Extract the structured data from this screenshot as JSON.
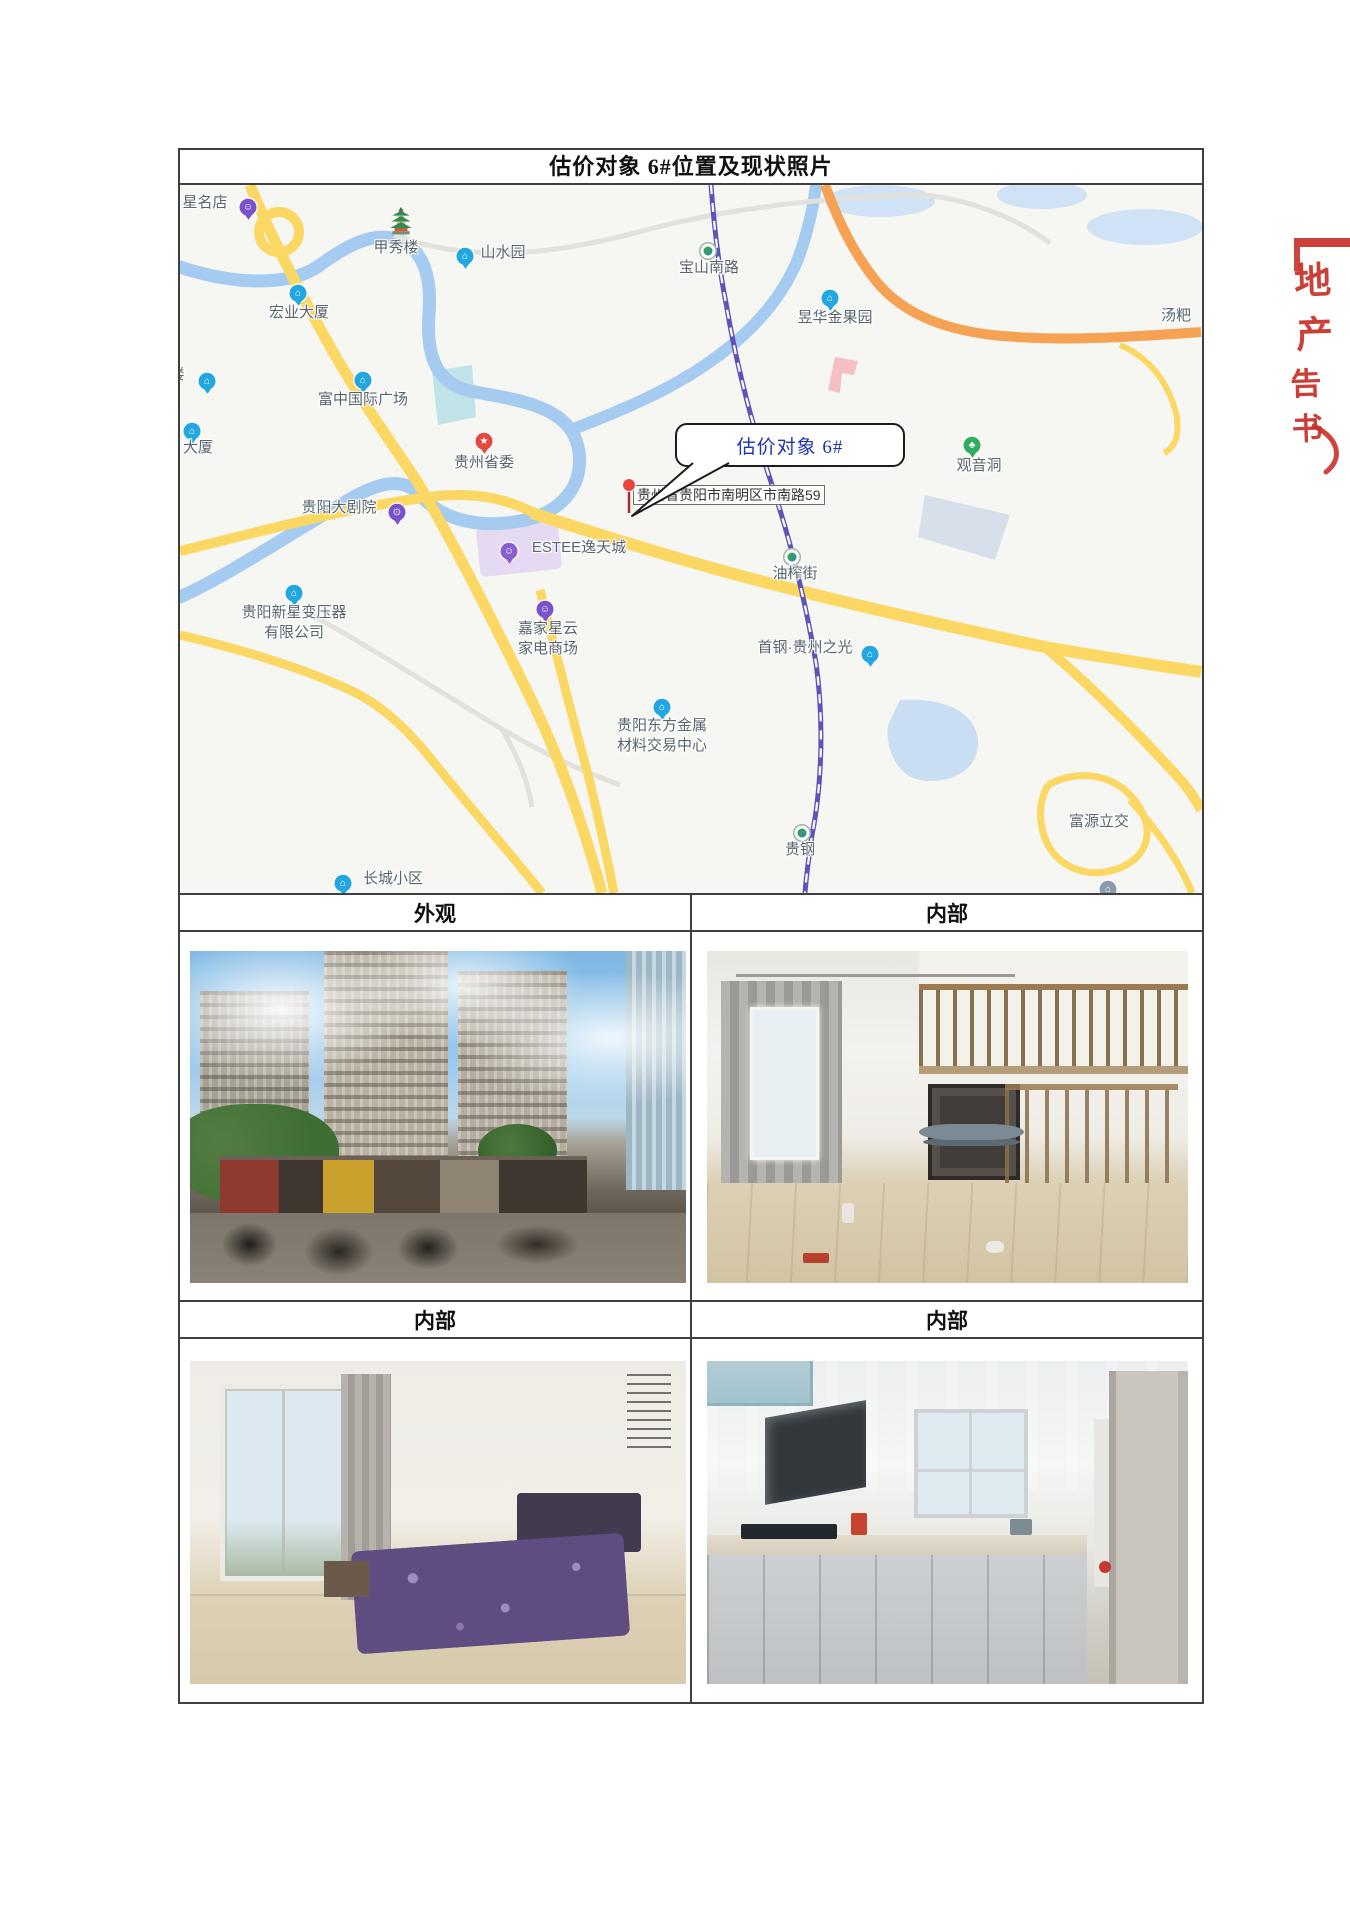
{
  "title": "估价对象 6#位置及现状照片",
  "map": {
    "callout_text": "估价对象 6#",
    "address_label": "贵州省贵阳市南明区市南路59",
    "markers": [
      {
        "lines": [
          "星名店"
        ],
        "x": 25,
        "y": 18,
        "icon": "shop",
        "color": "#7a52cc",
        "icon_x": 68,
        "icon_y": 26
      },
      {
        "lines": [
          "甲秀楼"
        ],
        "x": 216,
        "y": 63,
        "icon": "pagoda",
        "icon_x": 221,
        "icon_y": 50
      },
      {
        "lines": [
          "山水园"
        ],
        "x": 323,
        "y": 68,
        "icon": "building",
        "color": "#22a7e0",
        "icon_x": 285,
        "icon_y": 75
      },
      {
        "lines": [
          "宝山南路"
        ],
        "x": 529,
        "y": 83,
        "icon": "metro",
        "icon_x": 528,
        "icon_y": 66
      },
      {
        "lines": [
          "宏业大厦"
        ],
        "x": 119,
        "y": 128,
        "icon": "building",
        "color": "#22a7e0",
        "icon_x": 118,
        "icon_y": 112
      },
      {
        "lines": [
          "昱华金果园"
        ],
        "x": 655,
        "y": 133,
        "icon": "building",
        "color": "#22a7e0",
        "icon_x": 650,
        "icon_y": 117
      },
      {
        "lines": [
          "富中国际广场"
        ],
        "x": 183,
        "y": 215,
        "icon": "building",
        "color": "#22a7e0",
        "icon_x": 183,
        "icon_y": 199
      },
      {
        "lines": [
          "贵州省委"
        ],
        "x": 304,
        "y": 278,
        "icon": "star",
        "color": "#e2483d",
        "icon_x": 304,
        "icon_y": 260
      },
      {
        "lines": [
          "观音洞"
        ],
        "x": 799,
        "y": 281,
        "icon": "park",
        "color": "#2fae60",
        "icon_x": 792,
        "icon_y": 264
      },
      {
        "lines": [
          "贵阳大剧院"
        ],
        "x": 159,
        "y": 323,
        "icon": "theater",
        "color": "#7a52cc",
        "icon_x": 217,
        "icon_y": 331
      },
      {
        "lines": [
          "ESTEE逸天城"
        ],
        "x": 399,
        "y": 363,
        "icon": "shop",
        "color": "#8b5fd0",
        "icon_x": 329,
        "icon_y": 370
      },
      {
        "lines": [
          "贵阳新星变压器",
          "有限公司"
        ],
        "x": 114,
        "y": 428,
        "icon": "building",
        "color": "#22a7e0",
        "icon_x": 114,
        "icon_y": 412
      },
      {
        "lines": [
          "嘉家星云",
          "家电商场"
        ],
        "x": 368,
        "y": 444,
        "icon": "shop",
        "color": "#7a52cc",
        "icon_x": 365,
        "icon_y": 428
      },
      {
        "lines": [
          "油榨街"
        ],
        "x": 615,
        "y": 389,
        "icon": "metro",
        "icon_x": 612,
        "icon_y": 372
      },
      {
        "lines": [
          "首钢·贵州之光"
        ],
        "x": 625,
        "y": 463,
        "icon": "building",
        "color": "#22a7e0",
        "icon_x": 690,
        "icon_y": 473
      },
      {
        "lines": [
          "贵阳东方金属",
          "材料交易中心"
        ],
        "x": 482,
        "y": 541,
        "icon": "building",
        "color": "#22a7e0",
        "icon_x": 482,
        "icon_y": 526
      },
      {
        "lines": [
          "贵钢"
        ],
        "x": 620,
        "y": 665,
        "icon": "metro",
        "icon_x": 622,
        "icon_y": 648
      },
      {
        "lines": [
          "富源立交"
        ],
        "x": 919,
        "y": 637
      },
      {
        "lines": [
          "长城小区"
        ],
        "x": 213,
        "y": 694,
        "icon": "building",
        "color": "#22a7e0",
        "icon_x": 163,
        "icon_y": 702
      },
      {
        "lines": [
          "汤粑"
        ],
        "x": 996,
        "y": 131
      },
      {
        "lines": [
          "大厦"
        ],
        "x": 18,
        "y": 263,
        "icon": "building",
        "color": "#22a7e0",
        "icon_x": 12,
        "icon_y": 250
      },
      {
        "lines": [
          "楼"
        ],
        "x": -3,
        "y": 190,
        "icon": "building",
        "color": "#22a7e0",
        "icon_x": 27,
        "icon_y": 200
      },
      {
        "lines": [],
        "icon": "building",
        "color": "#8a9bb0",
        "icon_x": 928,
        "icon_y": 708
      }
    ]
  },
  "sections": [
    {
      "left": "外观",
      "right": "内部"
    },
    {
      "left": "内部",
      "right": "内部"
    }
  ],
  "stamp": {
    "fragment_top": "地产",
    "fragment_bottom": "告书"
  }
}
